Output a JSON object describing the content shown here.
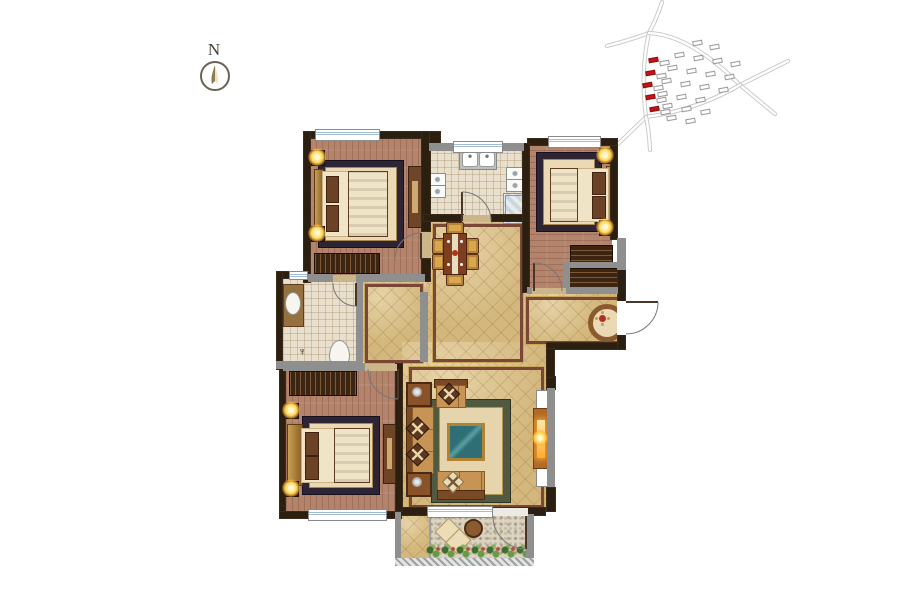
{
  "compass": {
    "label": "N"
  },
  "icons": {
    "floor_drain": "♆"
  },
  "colors": {
    "wall_dark": "#2b1f12",
    "wall_gray": "#8f8f8f",
    "wood_floor": "#b3836b",
    "tile_floor": "#e8dfcc",
    "marble_floor": "#d3b77c",
    "marble_border": "#7a4636",
    "window_blue": "#a3bdd0",
    "lamp_glow": "#ffd34e",
    "accent_red": "#b23020",
    "plant_green": "#6a9a44",
    "glass_teal": "#2e6e74",
    "site_red": "#c41414",
    "site_gray": "#9c9c9c",
    "road_gray": "#c6c6c6"
  }
}
